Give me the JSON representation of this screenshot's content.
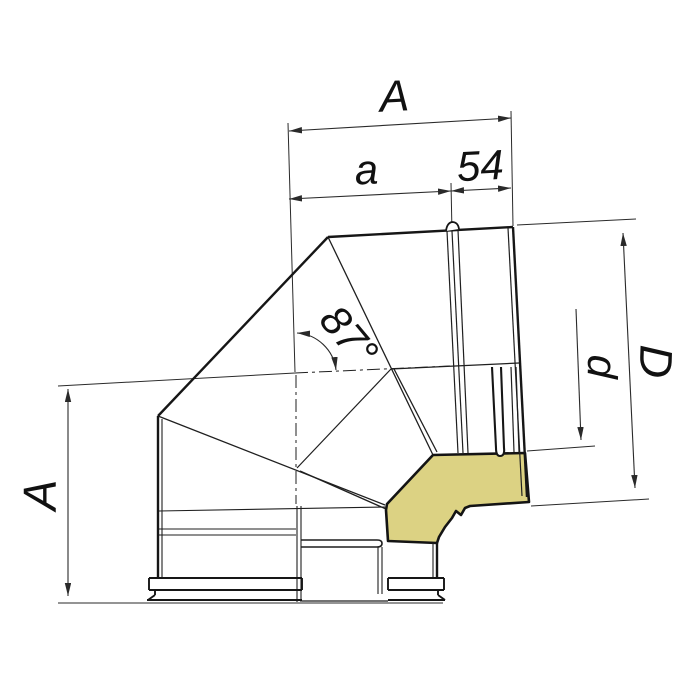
{
  "drawing": {
    "type": "technical-drawing",
    "subject": "87 degree insulated sandwich chimney elbow, side view with insulation cutaway",
    "labels": {
      "dim_width_total": "A",
      "dim_width_body": "a",
      "dim_socket": "54",
      "angle": "87°",
      "dim_outer_diameter": "D",
      "dim_inner_diameter": "d",
      "dim_height": "A"
    },
    "colors": {
      "line": "#161616",
      "dimension": "#2a2a2a",
      "insulation_fill": "#dcd283",
      "background": "#ffffff"
    }
  }
}
